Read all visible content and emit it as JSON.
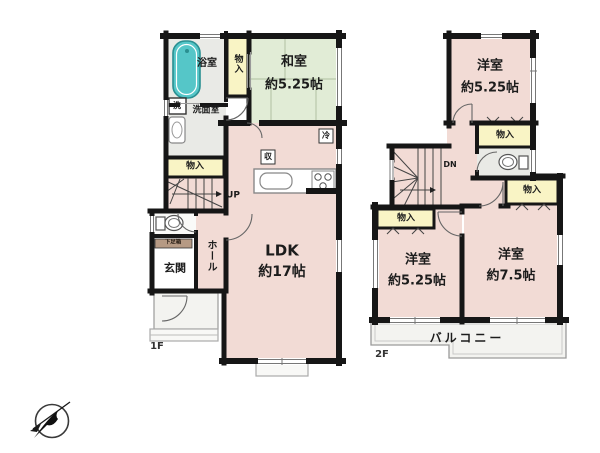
{
  "plan_type": "floor-plan",
  "colors": {
    "wall": "#161616",
    "room_pink": "#f2dbd5",
    "tatami_green": "#e1ecd6",
    "closet_yellow": "#f9f4c5",
    "wet_area_gray": "#e9eae6",
    "bathtub_teal": "#55c6c8",
    "shoe_box_tan": "#b69a84",
    "balcony_gray": "#f3f3f0"
  },
  "first_floor": {
    "floor_label": "1F",
    "bath_label": "浴室",
    "closet_vertical_label": "物入",
    "japanese_room_name": "和室",
    "japanese_room_size": "約5.25帖",
    "washer_label": "洗",
    "washroom_label": "洗面室",
    "closet_label": "物入",
    "stairs_label": "UP",
    "shoe_box_label": "下足箱",
    "entrance_label": "玄関",
    "hall_label": "ホール",
    "ldk_name": "LDK",
    "ldk_size": "約17帖",
    "fridge_label": "冷",
    "storage_label": "収"
  },
  "second_floor": {
    "floor_label": "2F",
    "bedroom1_name": "洋室",
    "bedroom1_size": "約5.25帖",
    "closet1_label": "物入",
    "stairs_label": "DN",
    "closet2_label": "物入",
    "bedroom2_name": "洋室",
    "bedroom2_size": "約5.25帖",
    "closet3_label": "物入",
    "bedroom3_name": "洋室",
    "bedroom3_size": "約7.5帖",
    "balcony_label": "バルコニー"
  }
}
